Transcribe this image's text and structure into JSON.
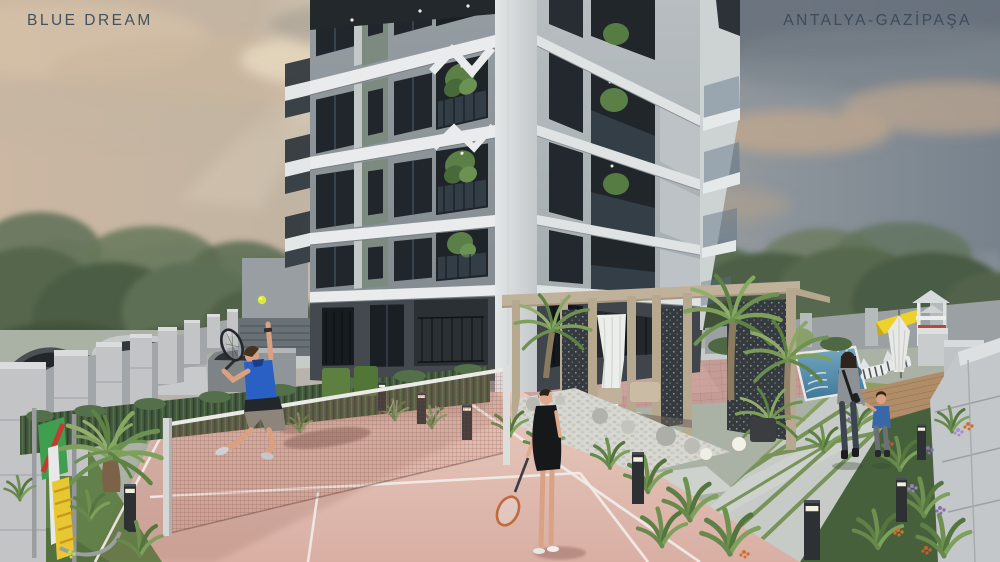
{
  "overlay": {
    "project_name": "BLUE DREAM",
    "location": "ANTALYA-GAZİPAŞA"
  },
  "palette": {
    "label_text": "#43525f",
    "sky_warm": "#c9b6a2",
    "sky_cool": "#77828c",
    "building_face_left": "#8f979c",
    "building_face_right": "#b2b8bb",
    "slab_white": "#e9ebec",
    "ground_floor_dark": "#43494e",
    "court_pink": "#e0bcb0",
    "court_line_white": "#f0ece8",
    "hedge_green": "#41563b",
    "grass_green": "#628049",
    "player_shirt_blue": "#2a5fc4",
    "dress_black": "#17181a",
    "pool_blue": "#5b93b2",
    "slide_yellow": "#ecd22a",
    "pergola_wood": "#c0b19b",
    "tennis_ball_yellow": "#dde83e"
  },
  "scene": {
    "type": "architectural exterior rendering",
    "building": "modern multi-storey apartment block with white balcony bands",
    "foreground": "pink tennis court with net, man serving, woman holding racket",
    "left": "concrete perimeter wall, parked cars, cycad palm, play frame",
    "right": "pergola lounge, pebble garden, pool with loungers, playground slide, mother and child on paver path",
    "background": "hazy mountains, trees, dramatic sky with sun rays"
  }
}
